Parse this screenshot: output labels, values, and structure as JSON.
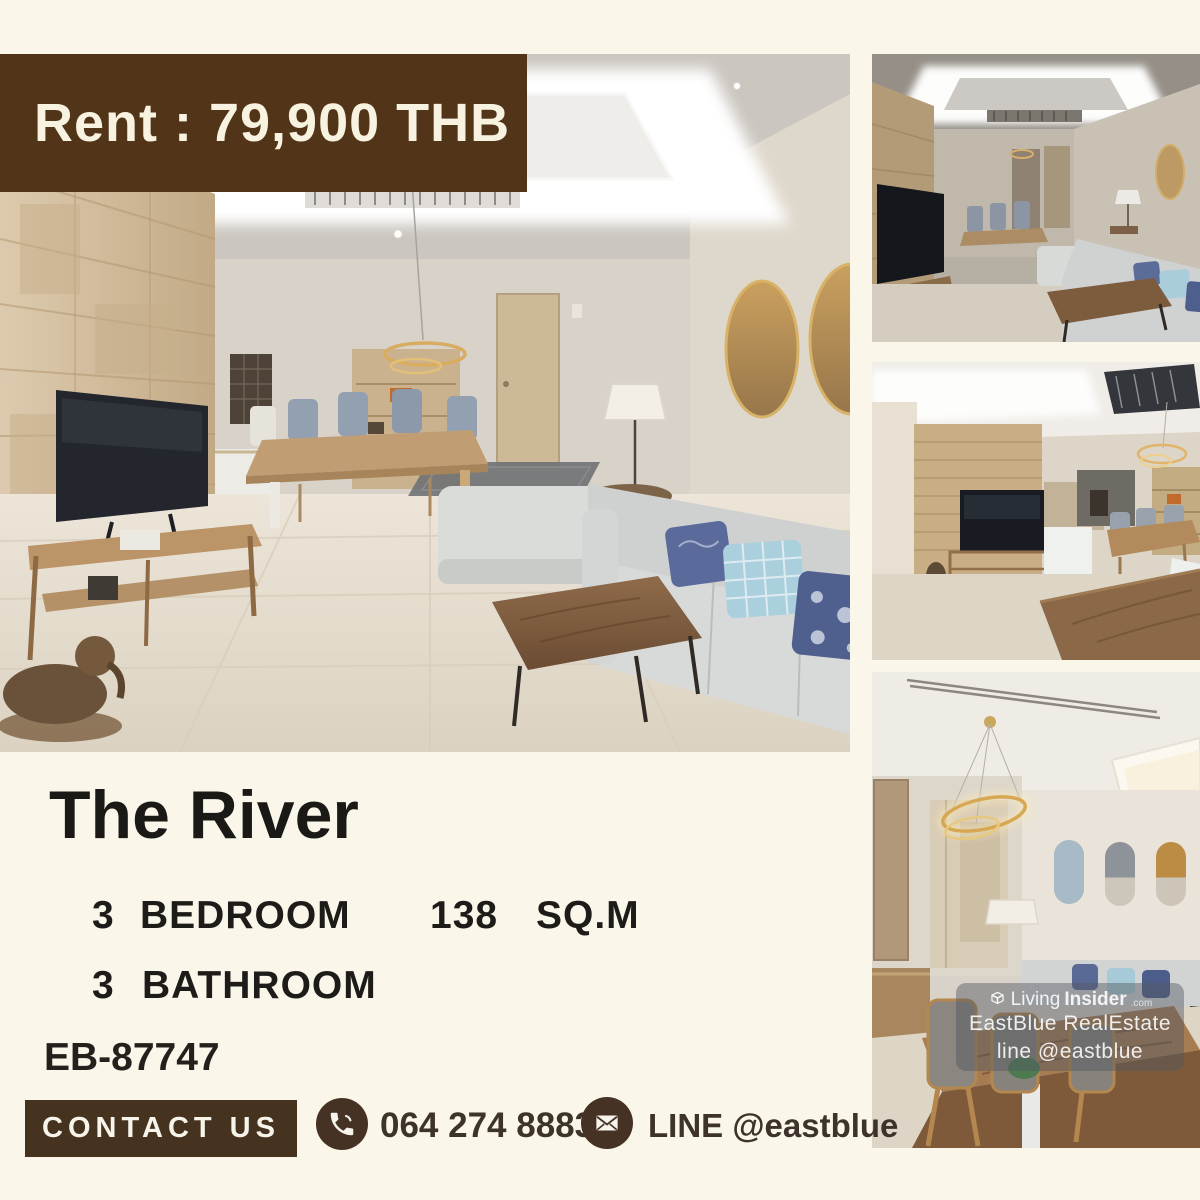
{
  "banner": {
    "label": "Rent : 79,900 THB",
    "bg_color": "#523418",
    "text_color": "#F8F2E1"
  },
  "listing": {
    "title": "The River",
    "bedroom_count": "3",
    "bedroom_label": "BEDROOM",
    "area_value": "138",
    "area_unit": "SQ.M",
    "bathroom_count": "3",
    "bathroom_label": "BATHROOM",
    "reference": "EB-87747"
  },
  "contact": {
    "button_label": "CONTACT US",
    "phone_number": "064 274 8883",
    "line_id": "LINE @eastblue",
    "accent_color": "#45321F"
  },
  "watermark": {
    "brand_prefix": "Living",
    "brand_suffix": "Insider",
    "brand_domain": ".com",
    "agency": "EastBlue RealEstate",
    "agency_line": "line @eastblue"
  },
  "icons": {
    "phone": "phone-icon",
    "mail": "envelope-icon",
    "brand_cube": "cube-logo-icon"
  },
  "colors": {
    "background": "#FBF6EA",
    "text_dark": "#1E1C19",
    "contact_text": "#3D332B"
  }
}
